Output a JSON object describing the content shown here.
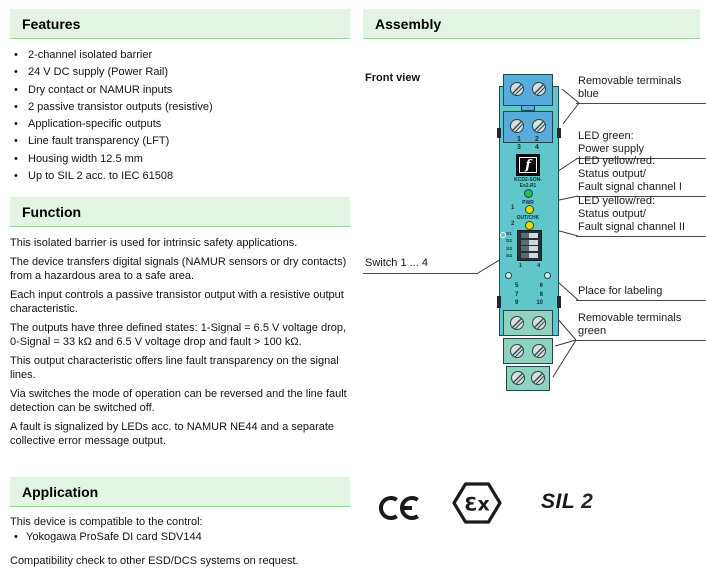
{
  "colors": {
    "header_bg": "#e2f5e2",
    "header_border": "#9fd49f",
    "device_teal": "#5fc7c9",
    "terminal_blue": "#58acdc",
    "terminal_green": "#8fd2bd",
    "led_green": "#2eb857",
    "led_yellow": "#f2d600"
  },
  "left": {
    "features": {
      "title": "Features",
      "items": [
        "2-channel isolated barrier",
        "24 V DC supply (Power Rail)",
        "Dry contact or NAMUR inputs",
        "2 passive transistor outputs (resistive)",
        "Application-specific outputs",
        "Line fault transparency (LFT)",
        "Housing width 12.5 mm",
        "Up to SIL 2 acc. to IEC 61508"
      ]
    },
    "function": {
      "title": "Function",
      "paragraphs": [
        "This isolated barrier is used for intrinsic safety applications.",
        "The device transfers digital signals (NAMUR sensors or dry contacts) from a hazardous area to a safe area.",
        "Each input controls a passive transistor output with a resistive output characteristic.",
        "The outputs have three defined states: 1-Signal = 6.5 V voltage drop, 0-Signal = 33 kΩ and 6.5 V voltage drop and fault > 100 kΩ.",
        "This output characteristic offers line fault transparency on the signal lines.",
        "Via switches the mode of operation can be reversed and the line fault detection can be switched off.",
        "A fault is signalized by LEDs acc. to NAMUR NE44 and a separate collective error message output."
      ]
    },
    "application": {
      "title": "Application",
      "intro": "This device is compatible to the control:",
      "bullet_item": "Yokogawa ProSafe DI card SDV144",
      "note": "Compatibility check to other ESD/DCS systems on request."
    }
  },
  "right": {
    "assembly_title": "Assembly",
    "front_view_label": "Front view",
    "callouts": {
      "terminals_blue": {
        "lines": [
          "Removable terminals",
          "blue"
        ]
      },
      "led_power": {
        "lines": [
          "LED green:",
          "Power supply"
        ]
      },
      "led_ch1": {
        "lines": [
          "LED yellow/red:",
          "Status output/",
          "Fault signal channel I"
        ]
      },
      "led_ch2": {
        "lines": [
          "LED yellow/red:",
          "Status output/",
          "Fault signal channel II"
        ]
      },
      "labeling": {
        "lines": [
          "Place for labeling"
        ]
      },
      "terminals_green": {
        "lines": [
          "Removable terminals",
          "green"
        ]
      },
      "switches": "Switch 1 ... 4"
    },
    "device": {
      "top_terminal_numbers": [
        [
          "1",
          "2"
        ],
        [
          "3",
          "4"
        ]
      ],
      "logo_glyph": "f",
      "model_lines": [
        "KCD2-SON-",
        "Ex2.R1"
      ],
      "pwr_label": "PWR",
      "out_chk_label": "OUT/CHK",
      "channel_numbers": [
        "1",
        "2"
      ],
      "switch_labels": [
        "S1",
        "S2",
        "S3",
        "S4"
      ],
      "dip_end_numbers": [
        "1",
        "4"
      ],
      "mid_terminal_numbers": [
        [
          "5",
          "6"
        ],
        [
          "7",
          "8"
        ],
        [
          "9",
          "10"
        ]
      ]
    },
    "marks": {
      "ce": "CE",
      "ex": "Ɛx",
      "sil": "SIL",
      "sil_level": "2"
    }
  }
}
